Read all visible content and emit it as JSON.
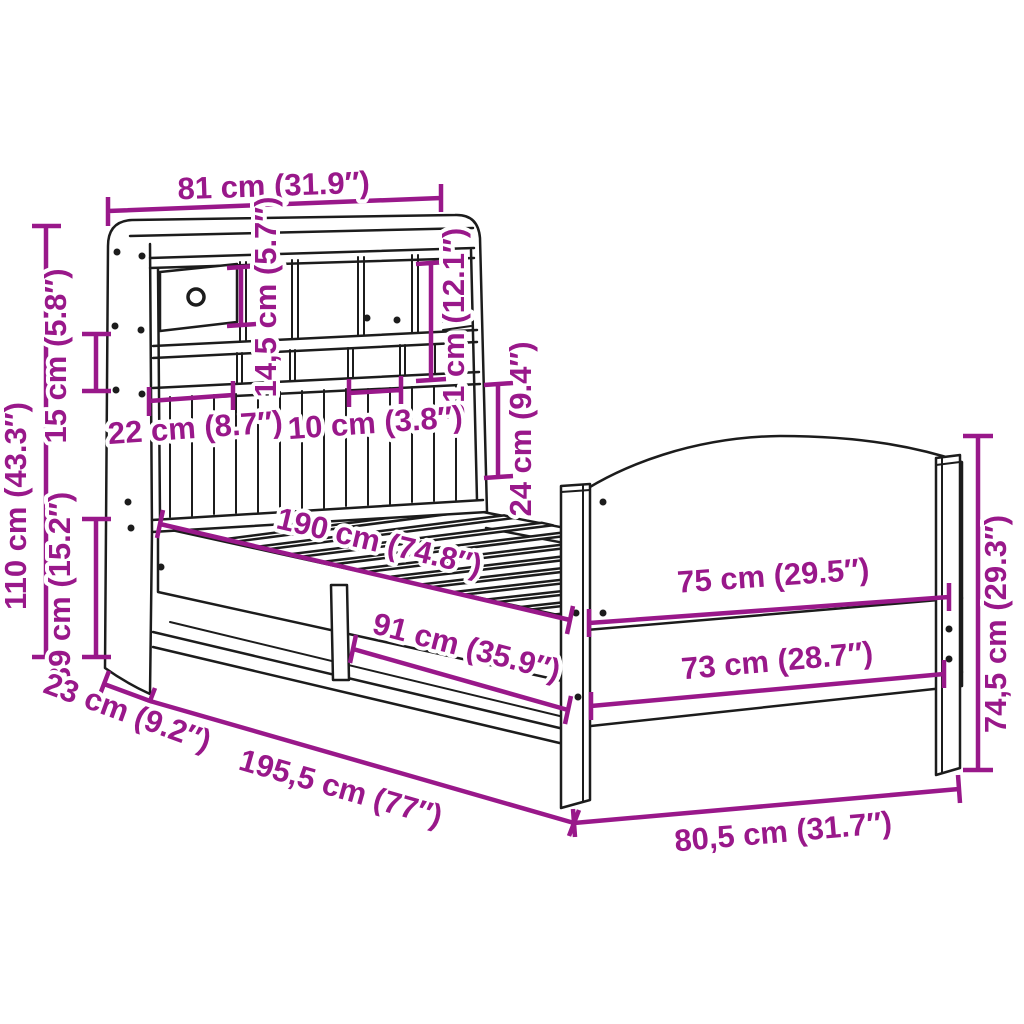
{
  "diagram": {
    "subject": "bed-with-bookshelf-headboard-dimension-diagram",
    "colors": {
      "dimension": "#99188A",
      "line_art": "#1c1c1c",
      "background": "#ffffff"
    },
    "dimensions": [
      {
        "id": "shelf-width",
        "label": "81 cm (31.9″)"
      },
      {
        "id": "headboard-height",
        "label": "110 cm (43.3″)"
      },
      {
        "id": "shelf-gap",
        "label": "15 cm (5.8″)"
      },
      {
        "id": "base-height",
        "label": "39 cm (15.2″)"
      },
      {
        "id": "compartment-height",
        "label": "14,5 cm (5.7″)"
      },
      {
        "id": "tall-compartment",
        "label": "31 cm (12.1″)"
      },
      {
        "id": "clearance-height",
        "label": "24 cm (9.4″)"
      },
      {
        "id": "compartment-width",
        "label": "22 cm (8.7″)"
      },
      {
        "id": "slot-width",
        "label": "10 cm (3.8″)"
      },
      {
        "id": "mattress-length",
        "label": "190 cm (74.8″)"
      },
      {
        "id": "underbed-length",
        "label": "91 cm (35.9″)"
      },
      {
        "id": "footboard-top-width",
        "label": "75 cm (29.5″)"
      },
      {
        "id": "footboard-low-width",
        "label": "73 cm (28.7″)"
      },
      {
        "id": "footboard-height",
        "label": "74,5 cm (29.3″)"
      },
      {
        "id": "headboard-depth",
        "label": "23 cm (9.2″)"
      },
      {
        "id": "total-length",
        "label": "195,5 cm (77″)"
      },
      {
        "id": "total-width",
        "label": "80,5 cm (31.7″)"
      }
    ]
  }
}
